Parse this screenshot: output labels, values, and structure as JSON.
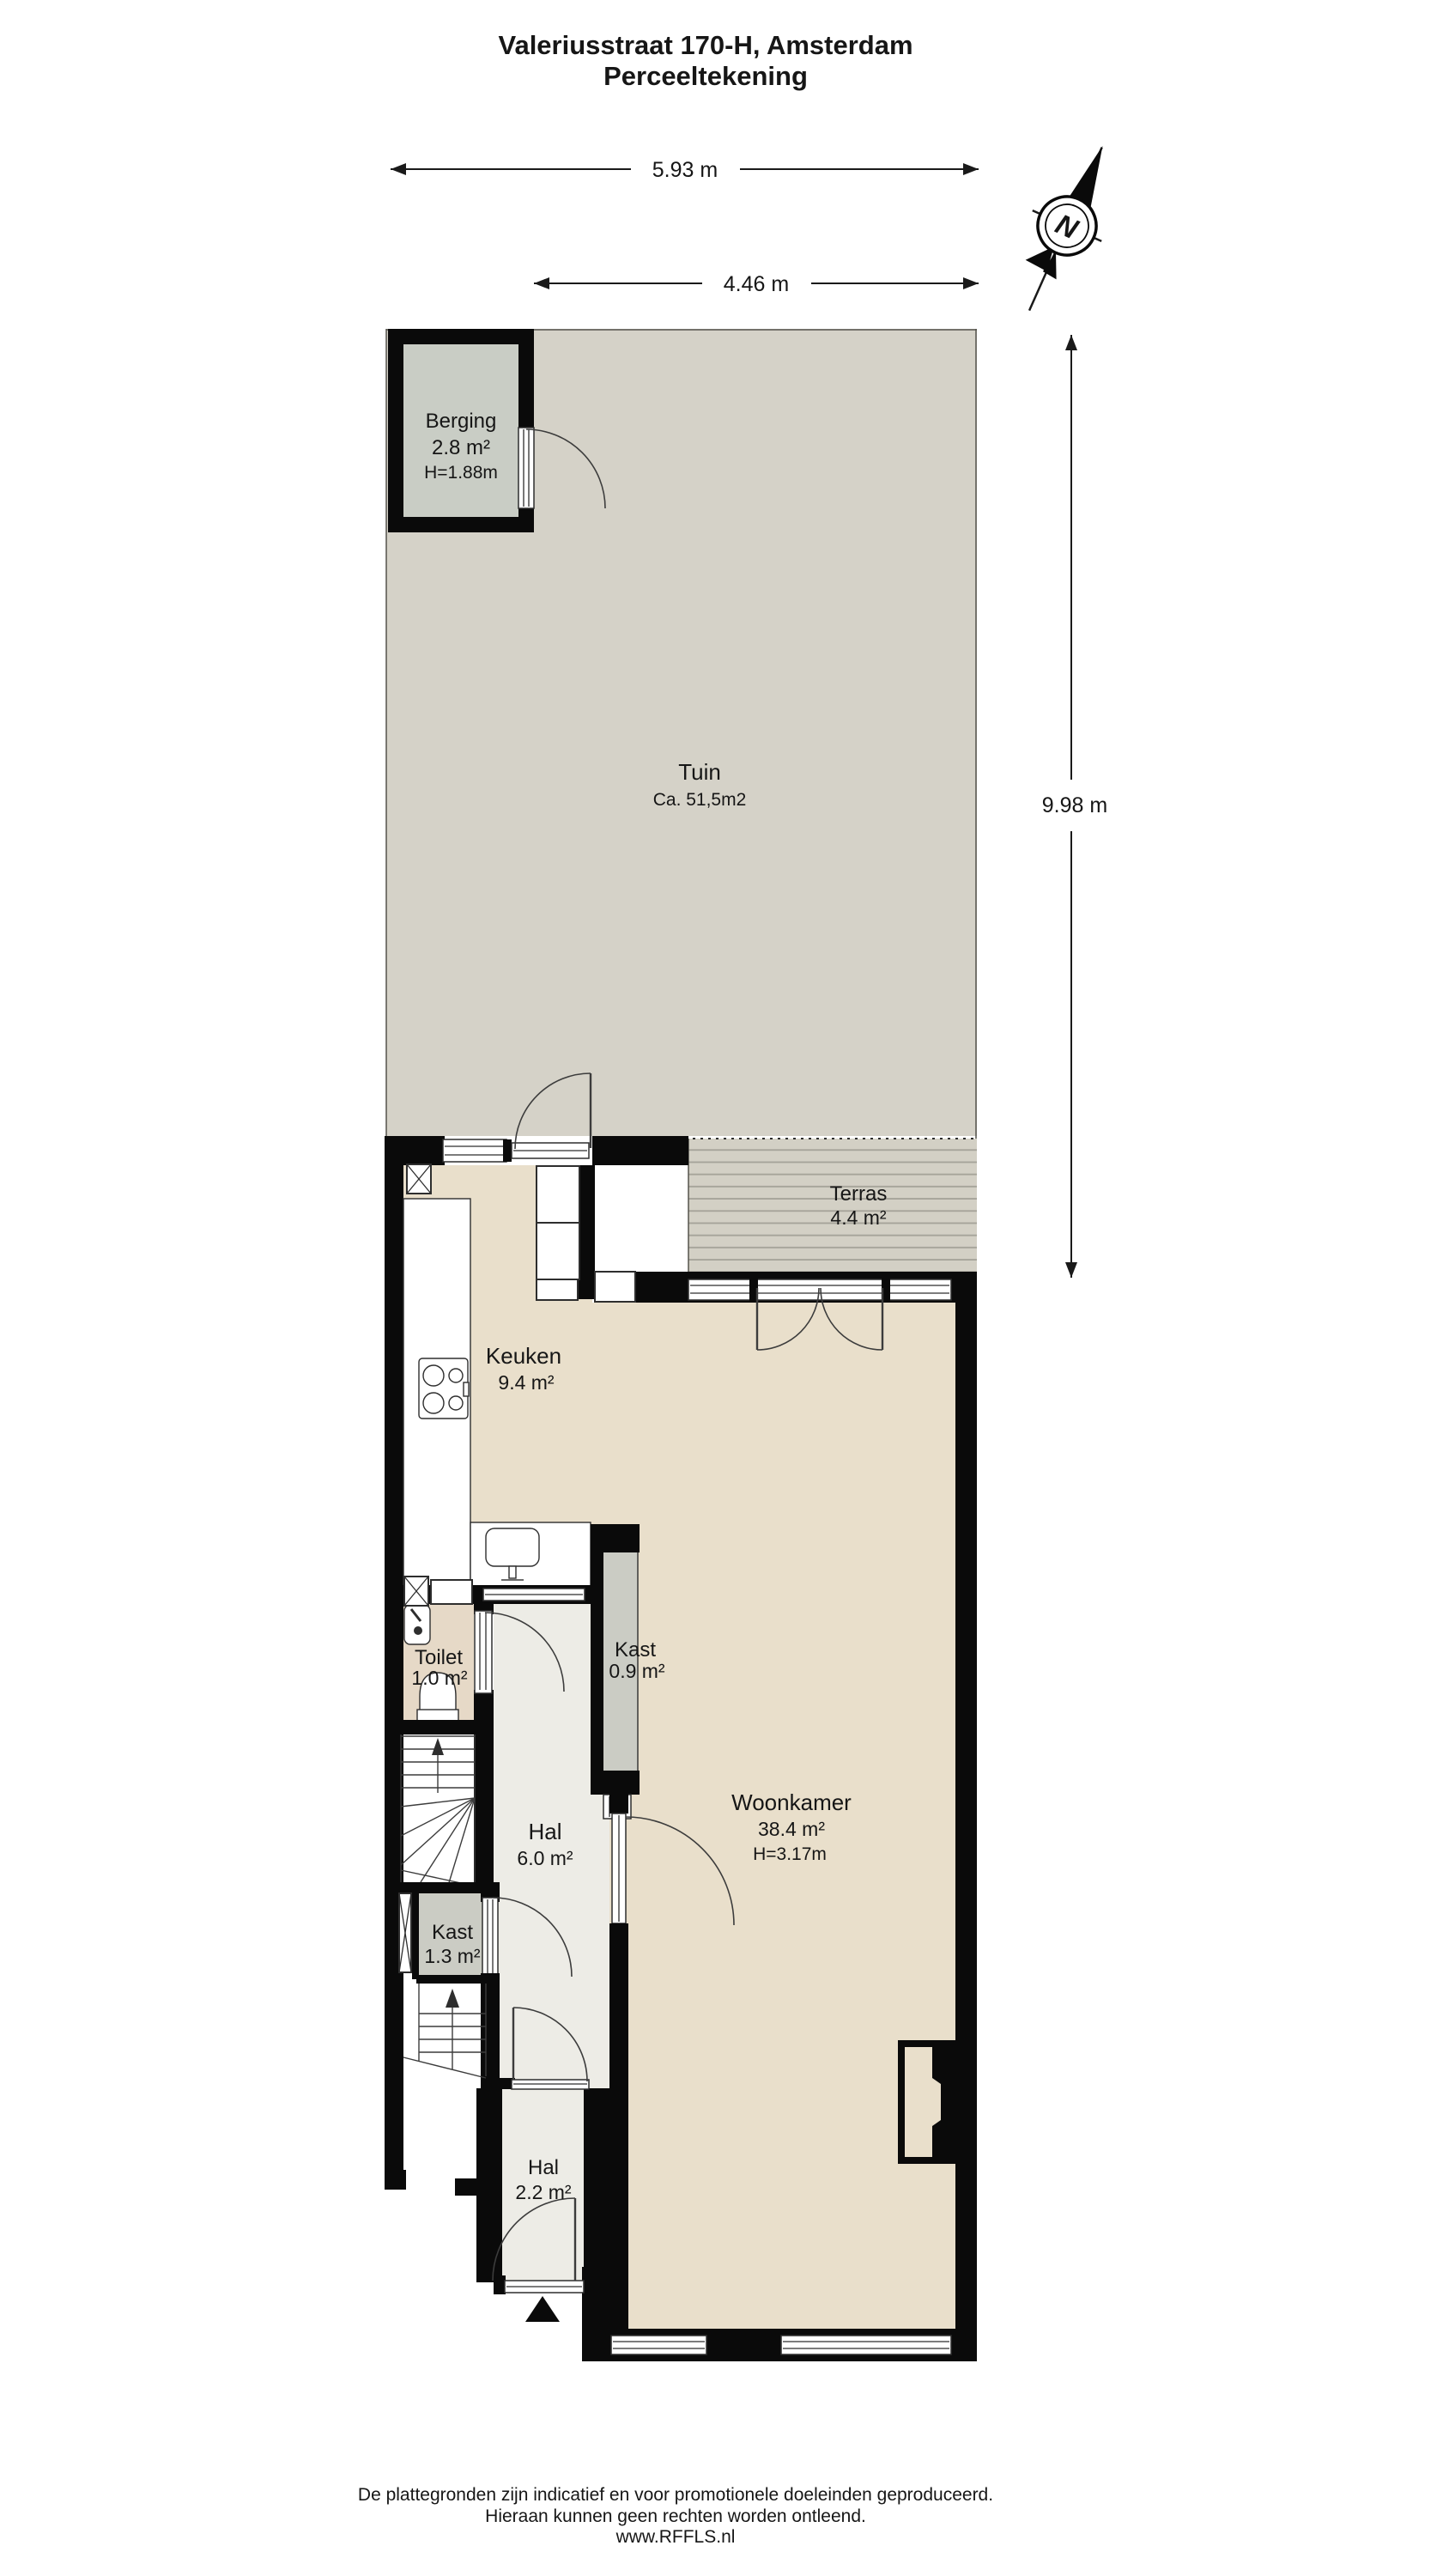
{
  "title": {
    "line1": "Valeriusstraat 170-H, Amsterdam",
    "line2": "Perceeltekening"
  },
  "dimensions": {
    "total_width": "5.93 m",
    "garden_width": "4.46 m",
    "garden_depth": "9.98 m"
  },
  "compass": {
    "north_label": "N"
  },
  "rooms": {
    "berging": {
      "name": "Berging",
      "area": "2.8 m²",
      "height": "H=1.88m"
    },
    "tuin": {
      "name": "Tuin",
      "area": "Ca. 51,5m2"
    },
    "terras": {
      "name": "Terras",
      "area": "4.4 m²"
    },
    "keuken": {
      "name": "Keuken",
      "area": "9.4 m²"
    },
    "toilet": {
      "name": "Toilet",
      "area": "1.0 m²"
    },
    "kast_klein": {
      "name": "Kast",
      "area": "0.9 m²"
    },
    "hal": {
      "name": "Hal",
      "area": "6.0 m²"
    },
    "woonkamer": {
      "name": "Woonkamer",
      "area": "38.4 m²",
      "height": "H=3.17m"
    },
    "kast": {
      "name": "Kast",
      "area": "1.3 m²"
    },
    "hal_entree": {
      "name": "Hal",
      "area": "2.2 m²"
    }
  },
  "footer": {
    "line1": "De plattegronden zijn indicatief en voor promotionele doeleinden geproduceerd.",
    "line2": "Hieraan kunnen geen rechten worden ontleend.",
    "line3": "www.RFFLS.nl"
  },
  "colors": {
    "wall": "#0a0a0a",
    "garden": "#d5d2c8",
    "shed_floor": "#c9cdc5",
    "deck": "#d3d0c5",
    "deck_stripe": "#a5a399",
    "living_floor": "#e9dfcb",
    "toilet_floor": "#e6d9c7",
    "hall_floor": "#edece6",
    "closet": "#cbccc4"
  }
}
